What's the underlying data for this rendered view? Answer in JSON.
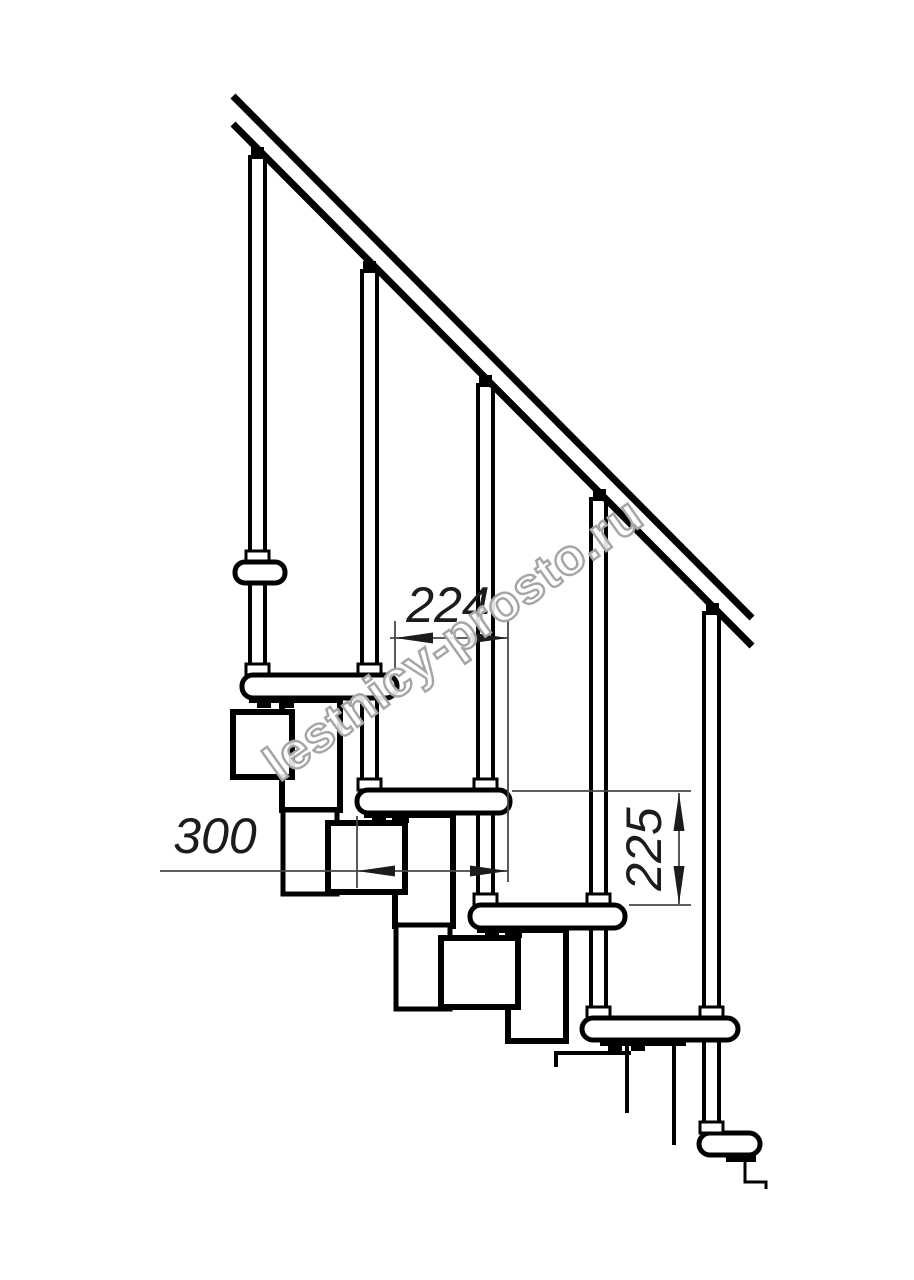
{
  "drawing": {
    "type": "technical side-view drawing of a modular staircase",
    "watermark": {
      "text": "lestnicy-prosto.ru"
    },
    "dimensions": {
      "run": {
        "value": "224",
        "meaning": "horizontal step run between tread edges, mm"
      },
      "depth": {
        "value": "300",
        "meaning": "tread depth, mm"
      },
      "rise": {
        "value": "225",
        "meaning": "vertical rise between treads, mm"
      }
    },
    "colors": {
      "line": "#000000",
      "dimension_line": "#474747",
      "dimension_text": "#1c1c1c",
      "watermark_outline": "#a5a5a5",
      "background": "#ffffff"
    },
    "parts": {
      "handrail": "inclined handrail (two parallel rails)",
      "balusters": "5 vertical balusters with caps and collars",
      "treads": "5 rounded-end treads",
      "modules": "chain of rectangular support modules descending diagonally"
    }
  }
}
